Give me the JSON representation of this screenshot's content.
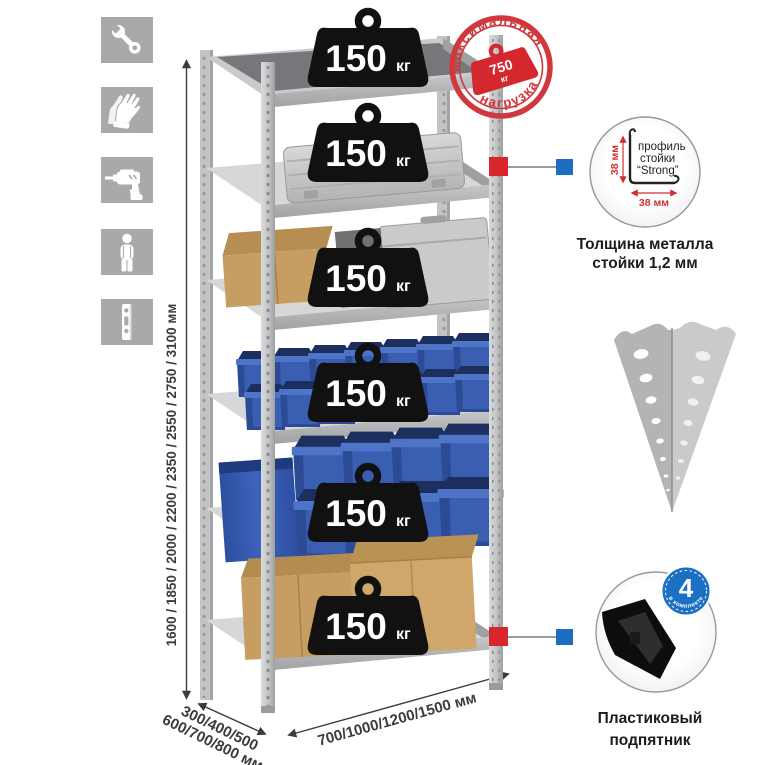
{
  "colors": {
    "accent_red": "#d5282e",
    "accent_blue": "#1b70c4",
    "bin_blue": "#3a5fb2",
    "metal_gray": "#c6c7c9",
    "icon_gray": "#a7a9ab",
    "weight_black": "#111111",
    "cardboard": "#c79e62"
  },
  "sidebar": {
    "icons": [
      "wrench-icon",
      "gloves-icon",
      "drill-icon",
      "person-icon",
      "rack-post-icon"
    ]
  },
  "height_dim": {
    "label": "1600 / 1850 / 2000 / 2200 / 2350 / 2550 / 2750 / 3100 мм"
  },
  "depth_dim": {
    "line1": "300/400/500",
    "line2": "600/700/800 мм"
  },
  "width_dim": {
    "label": "700/1000/1200/1500 мм"
  },
  "shelf_load": {
    "count": 6,
    "value": "150",
    "unit": "кг"
  },
  "stamp": {
    "arc_top": "максимальная",
    "arc_bottom": "нагрузка",
    "value": "750",
    "unit": "кг"
  },
  "profile_detail": {
    "line1": "профиль",
    "line2": "стойки",
    "line3": "“Strong”",
    "dim_vertical": "38 мм",
    "dim_horizontal": "38 мм",
    "caption_line1": "Толщина металла",
    "caption_line2": "стойки 1,2 мм"
  },
  "foot_detail": {
    "badge_value": "4",
    "badge_label": "в комплекте",
    "caption_line1": "Пластиковый",
    "caption_line2": "подпятник"
  }
}
